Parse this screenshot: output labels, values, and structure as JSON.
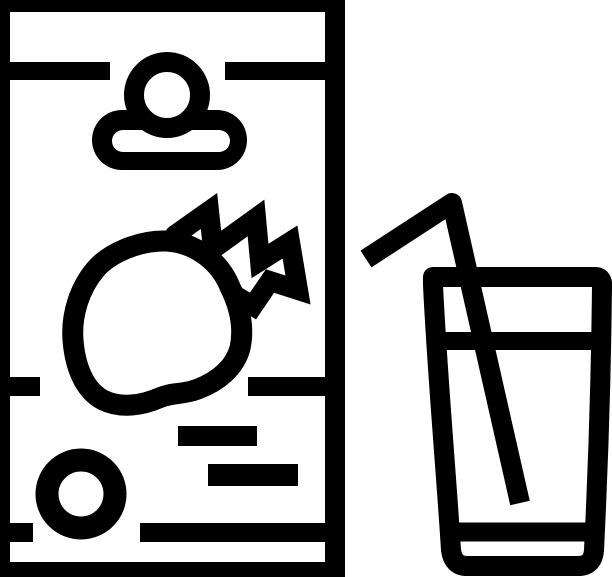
{
  "description": "Black and white line icon of a strawberry juice carton beside a glass of juice with a bent drinking straw",
  "colors": {
    "ink": "#000000",
    "paper": "#ffffff"
  },
  "carton": {
    "name": "juice-carton-icon",
    "decorations": [
      "bottle-cap-icon",
      "strawberry-icon",
      "label-text-bar",
      "label-text-bar",
      "label-dot-icon"
    ]
  },
  "glass": {
    "name": "juice-glass-icon",
    "parts": [
      "glass-outline",
      "juice-level-line",
      "glass-base-line",
      "straw-icon"
    ]
  }
}
